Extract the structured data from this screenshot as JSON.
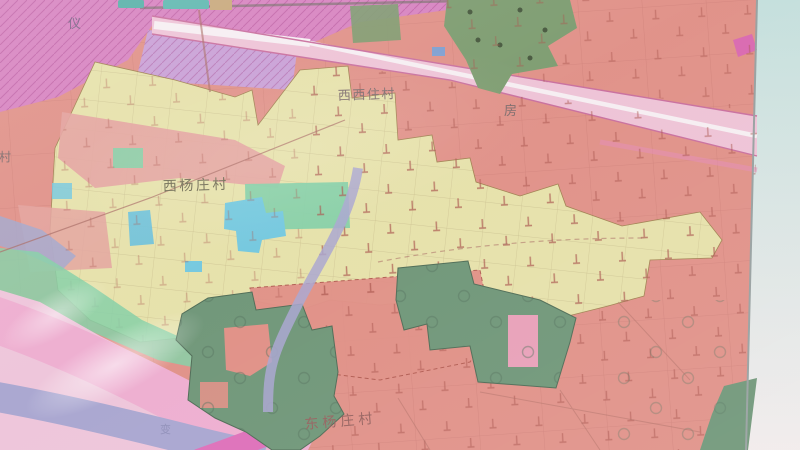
{
  "map": {
    "labels": {
      "char_top_left": "仪",
      "village_top": "西西住村",
      "char_road_right": "房",
      "village_center": "西杨庄村",
      "village_left_partial": "腾村",
      "village_bottom": "东杨庄村",
      "char_river": "变"
    },
    "colors": {
      "photo_bg_top": "#c4dfdc",
      "photo_bg_bottom": "#f1ebeb",
      "base_salmon": "#e09188",
      "zone_magenta": "#d783c0",
      "zone_magenta_bright": "#e264ab",
      "zone_lavender": "#c9a0d6",
      "road_pink": "#eec3d6",
      "village_yellow": "#e7e3ab",
      "water_cyan": "#74c8de",
      "green_mint": "#85cfa6",
      "green_sage": "#6f9678",
      "green_olive": "#7d9c70",
      "river_lavender": "#a9a6d0",
      "band_pink": "#eeaed0",
      "band_magenta": "#de6fb9",
      "corner_pink": "#eec5da"
    }
  }
}
